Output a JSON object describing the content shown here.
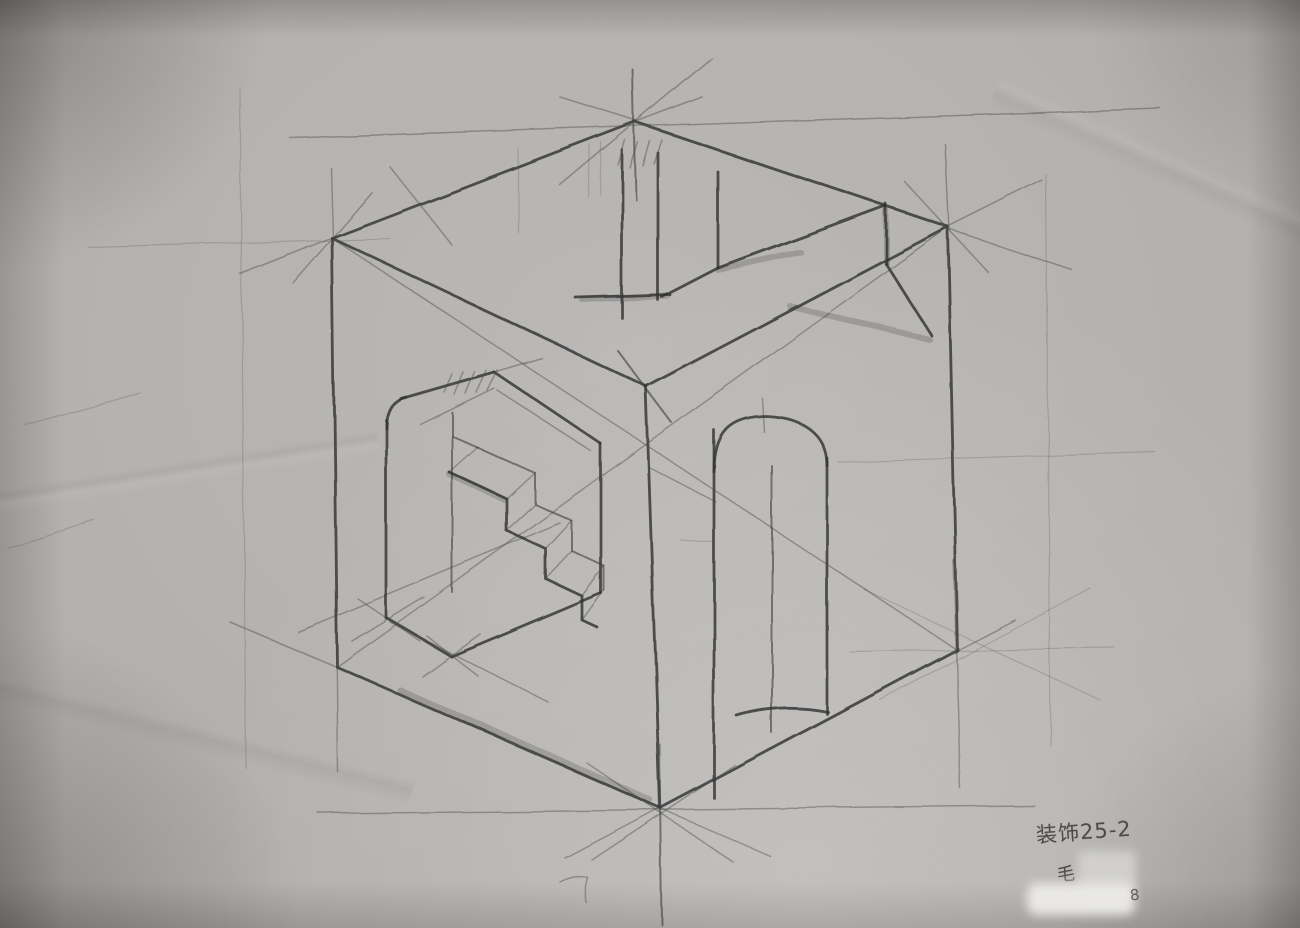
{
  "annotation": {
    "line1": "装饰25-2",
    "artist": "毛",
    "number": "8"
  },
  "colors": {
    "paper": "#b3b1ae",
    "pencil": "#343434",
    "annotation_ink": "#4e4c4a"
  },
  "sketch": {
    "lines": [
      [
        "h",
        332,
        238,
        635,
        122
      ],
      [
        "h",
        635,
        122,
        948,
        227
      ],
      [
        "h",
        332,
        238,
        646,
        386
      ],
      [
        "h",
        646,
        386,
        948,
        227
      ],
      [
        "h",
        332,
        238,
        337,
        667
      ],
      [
        "h",
        948,
        227,
        957,
        650
      ],
      [
        "h",
        646,
        386,
        660,
        808
      ],
      [
        "h",
        337,
        667,
        660,
        808
      ],
      [
        "h",
        660,
        808,
        957,
        650
      ],
      [
        "h",
        622,
        150,
        622,
        318
      ],
      [
        "h",
        658,
        153,
        658,
        300
      ],
      [
        "h",
        576,
        298,
        670,
        295
      ],
      [
        "h",
        662,
        297,
        718,
        268
      ],
      [
        "h",
        718,
        172,
        718,
        268
      ],
      [
        "h",
        718,
        268,
        886,
        206
      ],
      [
        "h",
        886,
        204,
        886,
        264
      ],
      [
        "h",
        886,
        264,
        932,
        336
      ],
      [
        "h",
        386,
        420,
        386,
        618
      ],
      [
        "h",
        400,
        399,
        494,
        372
      ],
      [
        "h",
        494,
        372,
        601,
        444
      ],
      [
        "h",
        601,
        444,
        601,
        593
      ],
      [
        "h",
        601,
        593,
        451,
        656
      ],
      [
        "h",
        451,
        656,
        387,
        618
      ],
      [
        "h",
        714,
        430,
        714,
        798
      ],
      [
        "h",
        827,
        458,
        827,
        714
      ],
      [
        "m",
        452,
        412,
        452,
        592
      ],
      [
        "m",
        772,
        466,
        772,
        733
      ],
      [
        "m",
        617,
        350,
        672,
        423
      ],
      [
        "m",
        633,
        70,
        636,
        200
      ],
      [
        "m",
        660,
        745,
        662,
        925
      ],
      [
        "m",
        452,
        436,
        477,
        447
      ],
      [
        "l",
        762,
        398,
        764,
        432
      ],
      [
        "l",
        240,
        274,
        336,
        236
      ],
      [
        "l",
        631,
        124,
        702,
        97
      ],
      [
        "l",
        560,
        97,
        637,
        121
      ],
      [
        "l",
        946,
        228,
        1072,
        270
      ],
      [
        "l",
        948,
        227,
        1042,
        180
      ],
      [
        "l",
        290,
        138,
        1160,
        108
      ],
      [
        "l",
        318,
        813,
        1035,
        806
      ],
      [
        "l",
        332,
        238,
        957,
        650
      ],
      [
        "l",
        948,
        227,
        337,
        667
      ],
      [
        "l",
        230,
        622,
        337,
        667
      ],
      [
        "l",
        660,
        808,
        770,
        856
      ],
      [
        "l",
        565,
        858,
        660,
        808
      ],
      [
        "l",
        957,
        650,
        1015,
        620
      ],
      [
        "l",
        331,
        168,
        333,
        240
      ],
      [
        "l",
        336,
        600,
        338,
        772
      ],
      [
        "l",
        946,
        145,
        950,
        230
      ],
      [
        "l",
        953,
        560,
        960,
        788
      ],
      [
        "l",
        293,
        283,
        372,
        193
      ],
      [
        "l",
        390,
        167,
        452,
        245
      ],
      [
        "l",
        905,
        182,
        988,
        272
      ],
      [
        "l",
        587,
        763,
        733,
        862
      ],
      [
        "l",
        592,
        860,
        735,
        765
      ],
      [
        "l",
        560,
        185,
        712,
        58
      ],
      [
        "l",
        650,
        468,
        716,
        502
      ],
      [
        "l",
        420,
        424,
        494,
        388
      ],
      [
        "l",
        497,
        390,
        592,
        452
      ],
      [
        "l",
        494,
        372,
        542,
        358
      ],
      [
        "l",
        298,
        632,
        560,
        523
      ],
      [
        "l",
        390,
        622,
        548,
        702
      ],
      [
        "l",
        357,
        598,
        420,
        641
      ],
      [
        "l",
        352,
        641,
        424,
        597
      ],
      [
        "l",
        427,
        636,
        478,
        676
      ],
      [
        "l",
        422,
        676,
        480,
        634
      ],
      [
        "l",
        449,
        472,
        477,
        447
      ],
      [
        "l",
        507,
        499,
        535,
        473
      ],
      [
        "l",
        507,
        531,
        535,
        504
      ],
      [
        "l",
        546,
        549,
        572,
        521
      ],
      [
        "l",
        546,
        579,
        572,
        551
      ],
      [
        "l",
        582,
        596,
        604,
        566
      ],
      [
        "l",
        582,
        620,
        604,
        590
      ],
      [
        "l",
        444,
        392,
        452,
        374
      ],
      [
        "l",
        454,
        394,
        463,
        372
      ],
      [
        "l",
        465,
        393,
        474,
        371
      ],
      [
        "l",
        476,
        392,
        486,
        370
      ],
      [
        "l",
        487,
        390,
        497,
        370
      ],
      [
        "l",
        618,
        165,
        625,
        140
      ],
      [
        "l",
        630,
        168,
        638,
        142
      ],
      [
        "l",
        643,
        166,
        650,
        141
      ],
      [
        "l",
        654,
        164,
        662,
        140
      ],
      [
        "f",
        850,
        652,
        1115,
        648
      ],
      [
        "f",
        865,
        590,
        1100,
        700
      ],
      [
        "f",
        880,
        700,
        1090,
        588
      ],
      [
        "f",
        240,
        88,
        246,
        768
      ],
      [
        "f",
        1046,
        175,
        1050,
        745
      ],
      [
        "f",
        88,
        247,
        390,
        239
      ],
      [
        "f",
        838,
        462,
        1155,
        452
      ],
      [
        "f",
        518,
        148,
        518,
        232
      ],
      [
        "f",
        590,
        145,
        588,
        196
      ],
      [
        "f",
        601,
        142,
        600,
        194
      ],
      [
        "f",
        25,
        425,
        140,
        393
      ],
      [
        "f",
        8,
        548,
        95,
        520
      ],
      [
        "f",
        680,
        540,
        712,
        542
      ],
      [
        "s",
        583,
        300,
        668,
        296
      ],
      [
        "s",
        790,
        306,
        930,
        340
      ],
      [
        "s",
        718,
        270,
        800,
        252
      ],
      [
        "s",
        886,
        210,
        886,
        262
      ],
      [
        "s",
        449,
        474,
        505,
        500
      ],
      [
        "s",
        400,
        690,
        650,
        800
      ]
    ],
    "paths": [
      [
        "h",
        "M714 472 C714 432 730 417 765 416 C800 417 827 432 827 466"
      ],
      [
        "h",
        "M737 716 Q782 703 828 712"
      ],
      [
        "h",
        "M386 428 Q386 402 406 397"
      ],
      [
        "h",
        "M449 472 L507 499 L507 531 L546 549 L546 579 L582 596 L582 620 L597 627"
      ],
      [
        "m",
        "M477 447 L535 473 L535 504 L572 521 L572 551 L604 566 L604 590"
      ],
      [
        "l",
        "M560 882 q16 -8 28 -4 q-4 14 -2 24"
      ]
    ]
  }
}
